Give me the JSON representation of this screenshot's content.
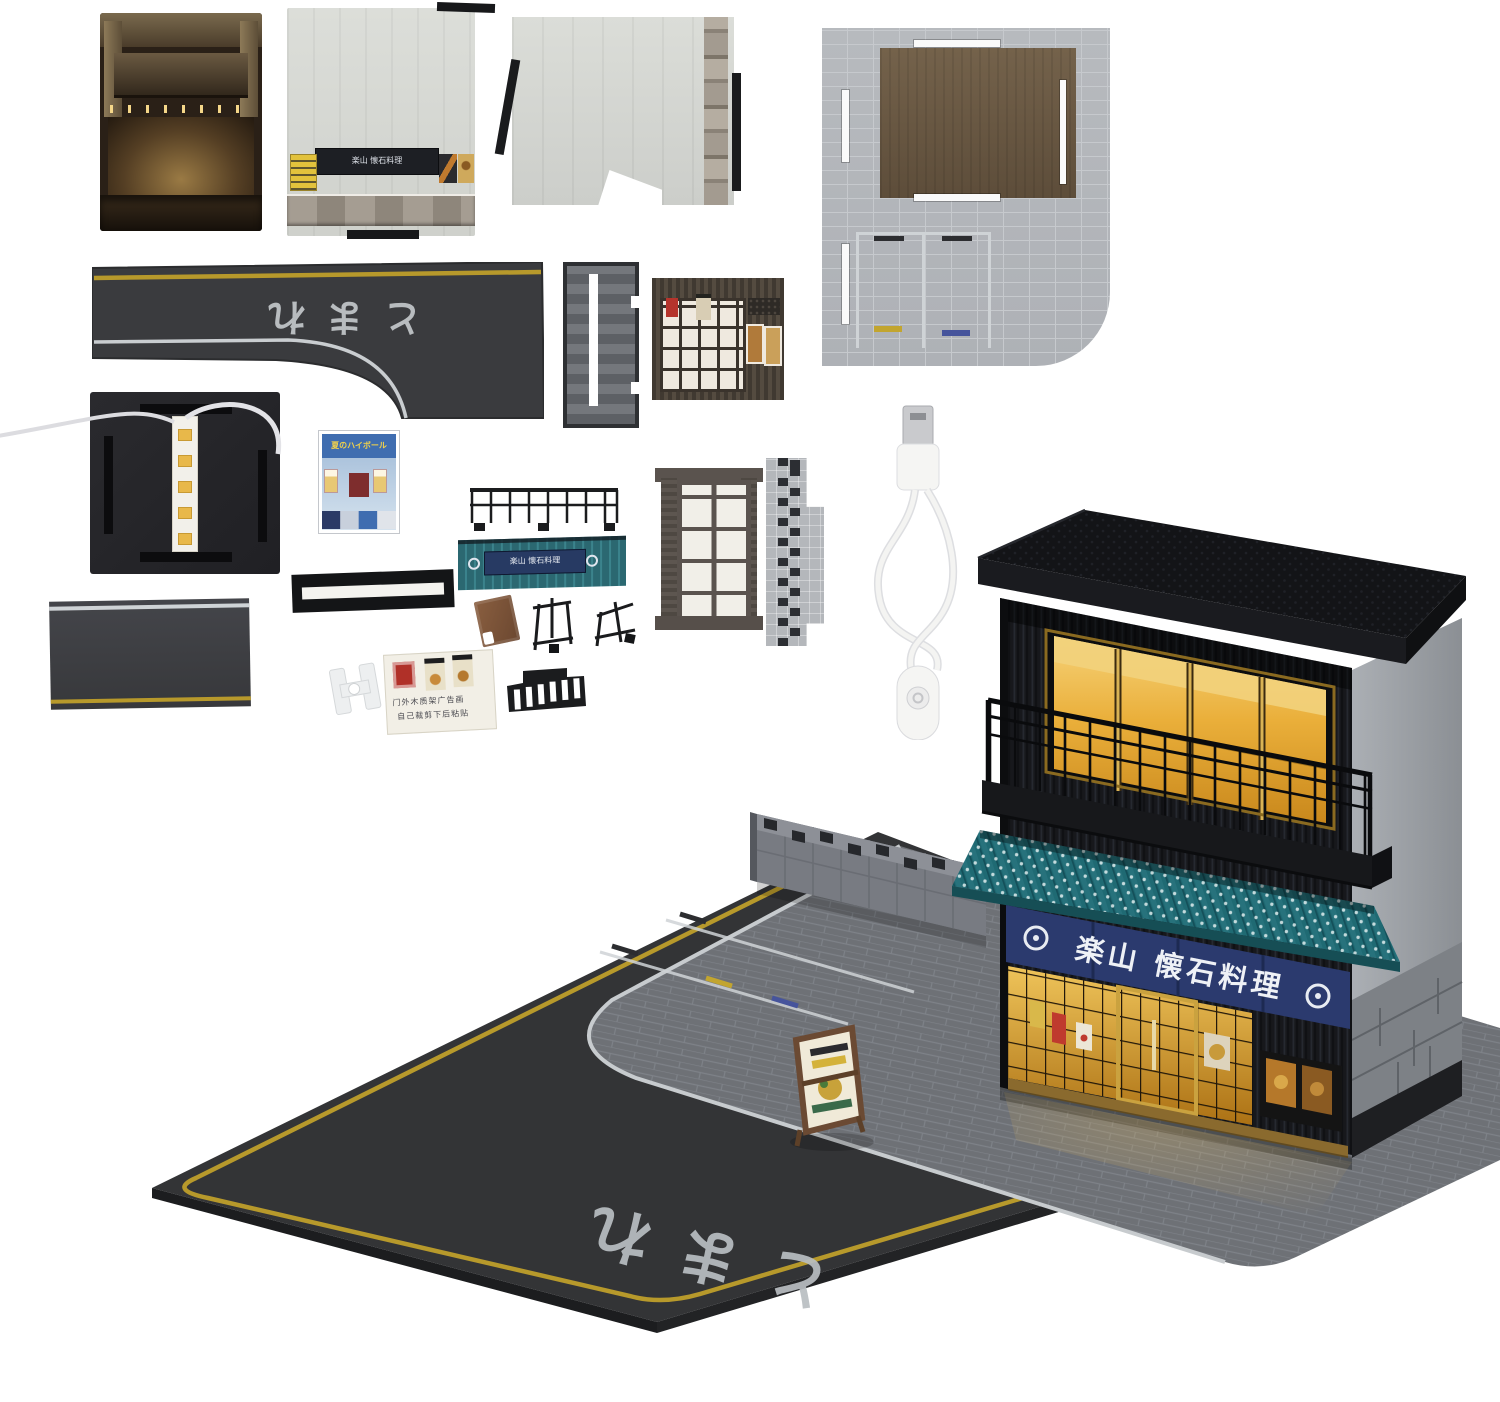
{
  "scene": {
    "type": "product-photo",
    "background_color": "#ffffff",
    "subject": "miniature Japanese izakaya diorama kit: flat card parts, LED base, USB cable and assembled two-story lit shop model on a road base"
  },
  "texts": {
    "road_marking_part": "とまれ",
    "road_marking_base": "とまれ",
    "noren_sign": "楽山 懐石料理",
    "awning_plaque_sign": "楽山 懐石料理",
    "wall_panel_sign": "楽山 懐石料理",
    "poster_sheet_title": "夏のハイボール",
    "instruction_card_line1": "门外木质架广告画",
    "instruction_card_line2": "自己裁剪下后粘贴"
  },
  "colors": {
    "awning_teal": "#20707a",
    "noren_blue": "#2b3a6e",
    "window_glow_amber": "#e9b546",
    "asphalt": "#333436",
    "lane_line_yellow": "#b7992b",
    "curb_line_white": "#c7cbce",
    "pavement_brick_grey": "#6e7176",
    "roof_black": "#131417",
    "wood_brown": "#6b5a45",
    "stone_wall_grey": "#9a9ea3",
    "led_strip_white": "#f2f0ea",
    "usb_cable_white": "#f4f4f2"
  },
  "parts": [
    "interior-print-card",
    "storefront-wall-panel",
    "side-wall-panel",
    "brick-ground-panel",
    "l-shaped-road-strip",
    "lattice-wall-strip",
    "shopfront-facade-panel",
    "led-base-plate",
    "poster-sheet",
    "balcony-railing",
    "awning-with-sign",
    "h-beam",
    "sign-board-blank",
    "sign-stand-wires",
    "window-frame",
    "checkered-wall-cap",
    "straight-road-strip",
    "white-clip",
    "sticker-card",
    "slotted-step-piece",
    "usb-power-cable",
    "assembled-diorama"
  ]
}
